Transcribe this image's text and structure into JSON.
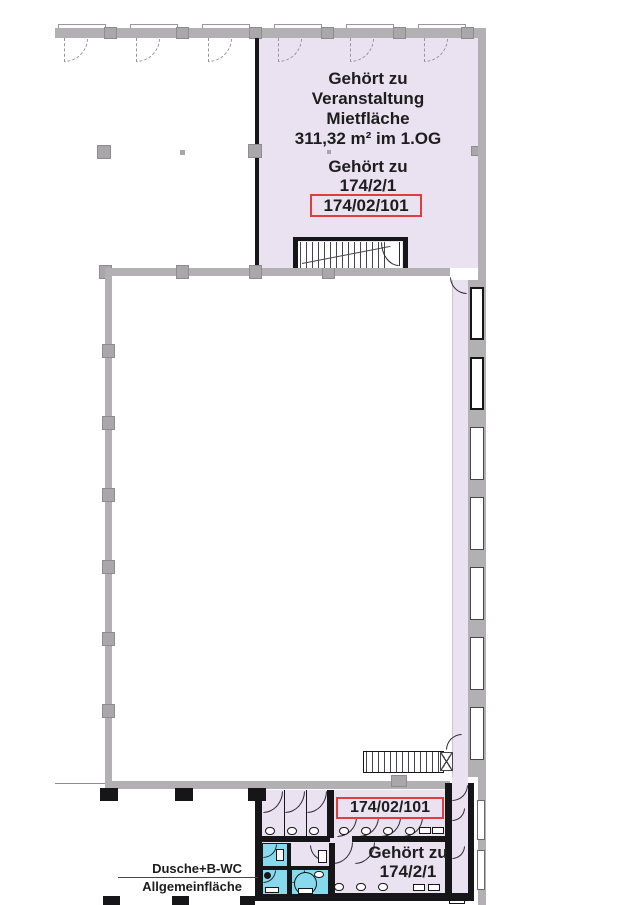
{
  "colors": {
    "area_fill": "#eae1f1",
    "wet_room_fill": "#87daee",
    "wall_gray": "#b3b0b4",
    "wall_black": "#161518",
    "highlight_red": "#e23d3d"
  },
  "upper_area": {
    "dedication": [
      "Gehört zu",
      "Veranstaltung",
      "Mietfläche",
      "311,32 m² im 1.OG"
    ],
    "parcel": [
      "Gehört zu",
      "174/2/1"
    ],
    "unit_code": "174/02/101"
  },
  "sanitary_area": {
    "unit_code": "174/02/101",
    "parcel": [
      "Gehört zu",
      "174/2/1"
    ],
    "annotation": [
      "Dusche+B-WC",
      "Allgemeinfläche"
    ]
  }
}
